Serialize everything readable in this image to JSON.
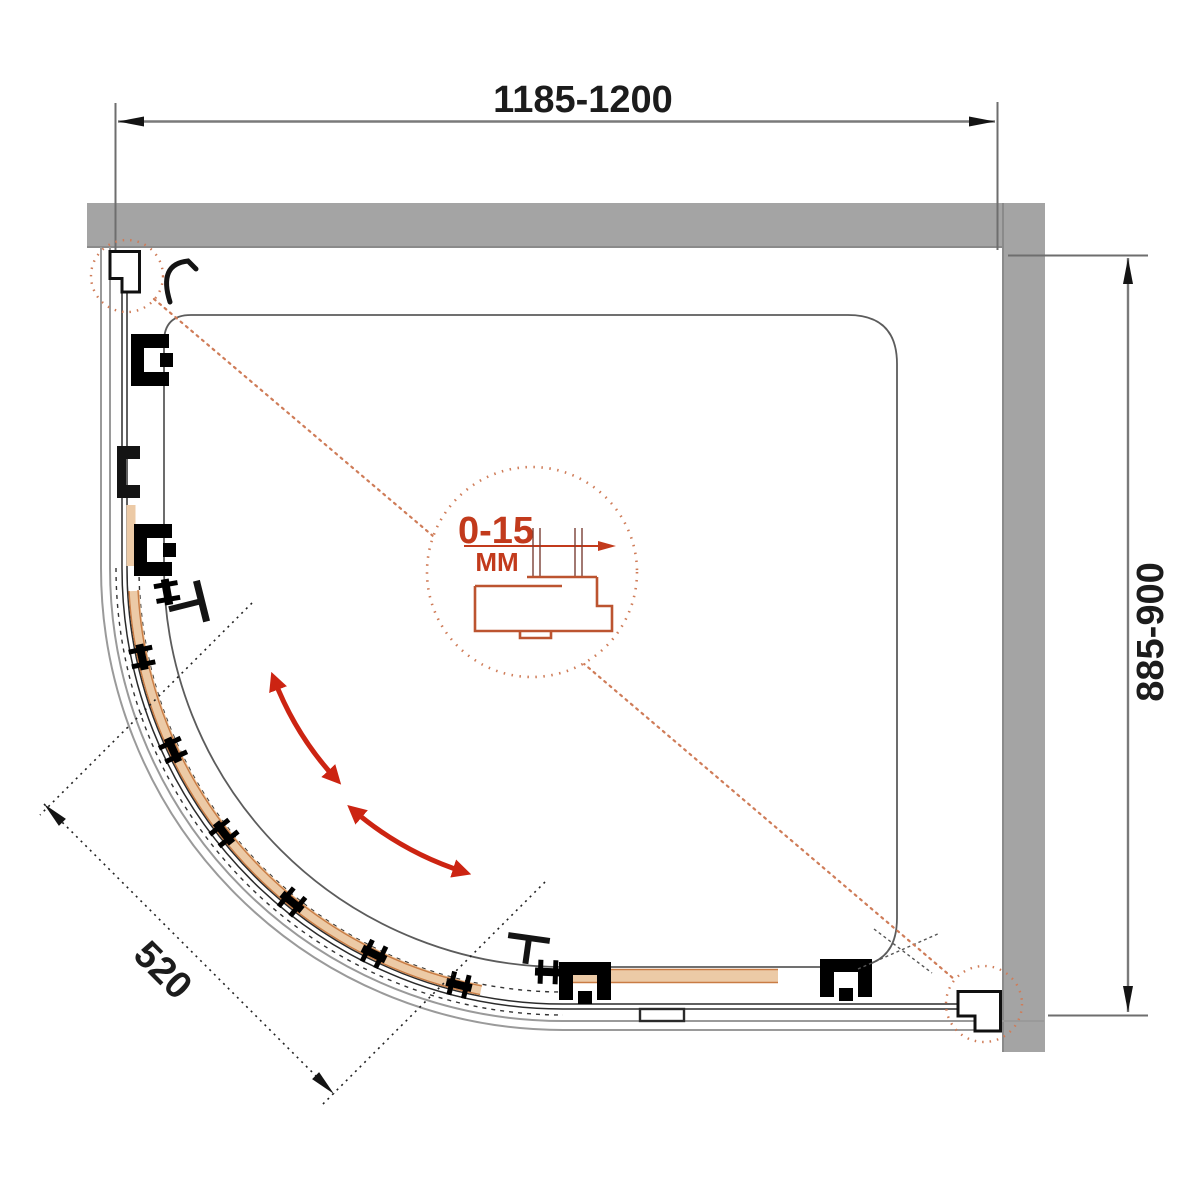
{
  "drawing": {
    "subject": "Quadrant shower enclosure - top view installation diagram",
    "dimensions": {
      "width_range": "1185-1200",
      "depth_range": "885-900",
      "entry_width": "520",
      "profile_adjustment": "0-15",
      "profile_adjustment_unit": "MM"
    },
    "colors": {
      "wall_gray": "#a4a4a4",
      "dimension_gray": "#7a7a7a",
      "line_black": "#1c1c1c",
      "leader_salmon": "#cf7c58",
      "detail_red": "#c23a1c",
      "profile_orange": "#bc5430",
      "door_tan": "#eccaa6",
      "door_tan_edge": "#c97c44",
      "arrow_red": "#cc2412"
    }
  }
}
